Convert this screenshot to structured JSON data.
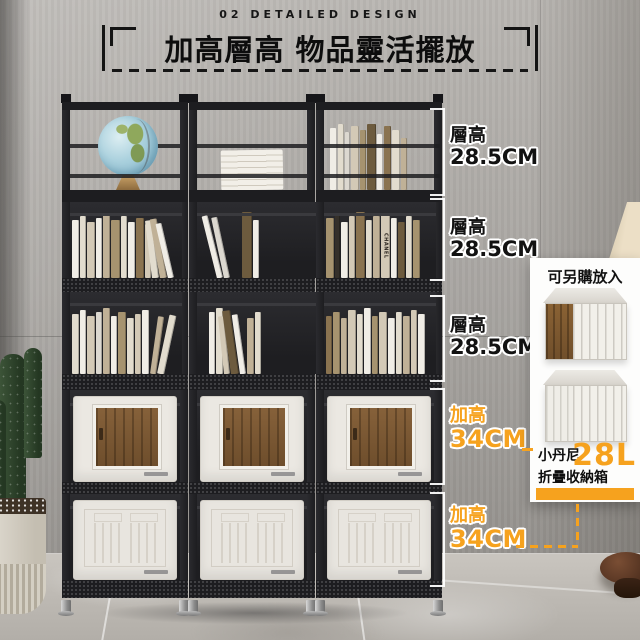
{
  "header": {
    "section_label": "02 DETAILED DESIGN",
    "title": "加高層高 物品靈活擺放"
  },
  "annotations": [
    {
      "label": "層高",
      "value": "28.5CM",
      "type": "layer-height"
    },
    {
      "label": "層高",
      "value": "28.5CM",
      "type": "layer-height"
    },
    {
      "label": "層高",
      "value": "28.5CM",
      "type": "layer-height"
    },
    {
      "label": "加高",
      "value": "34CM",
      "type": "raised-height"
    },
    {
      "label": "加高",
      "value": "34CM",
      "type": "raised-height"
    }
  ],
  "side_panel": {
    "title": "可另購放入",
    "product_line1": "小丹尼",
    "product_line2": "折疊收納箱",
    "capacity": "28L"
  },
  "decor": {
    "book_spine_text": "CHANEL"
  },
  "colors": {
    "accent_orange": "#F6A21E",
    "frame_black": "#1D1D20",
    "wall_gray": "#A9A6A2",
    "panel_white": "#FDFDFC"
  }
}
